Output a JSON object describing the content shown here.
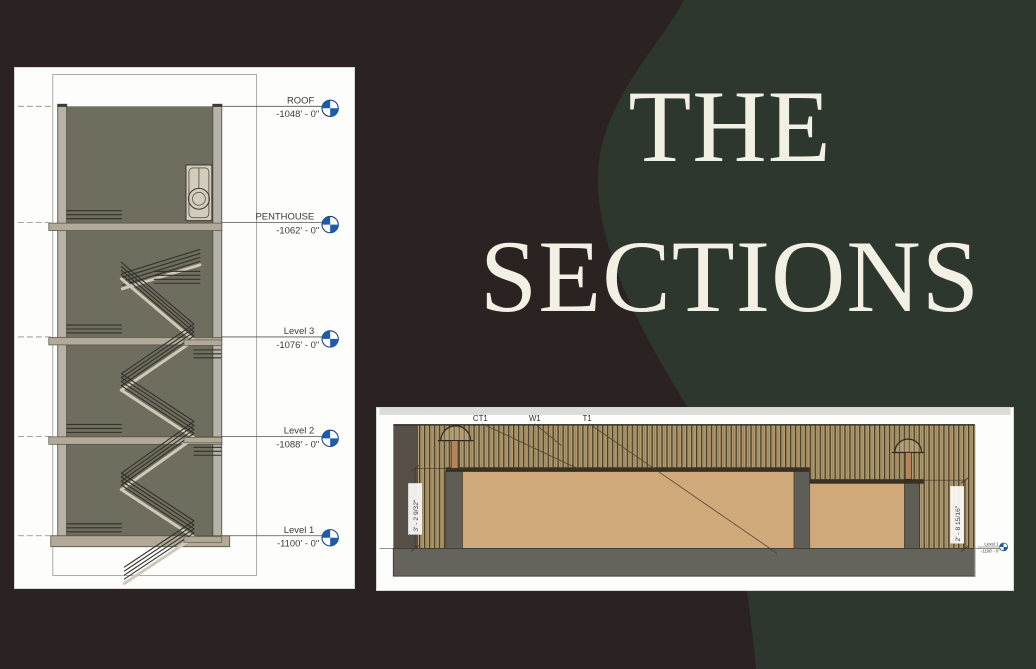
{
  "title": {
    "line1": "THE",
    "line2": "SECTIONS"
  },
  "colors": {
    "background_left": "#2a2321",
    "background_right": "#2d372d",
    "title_text": "#f2f0e5",
    "level_head_blue": "#1d5caa",
    "drawing_interior": "#6f6e5e",
    "counter_wood": "#d0a97a",
    "slat_wall": "#b29b6e"
  },
  "stair_section": {
    "levels": [
      {
        "name": "ROOF",
        "elevation": "-1048' - 0\""
      },
      {
        "name": "PENTHOUSE",
        "elevation": "-1062' - 0\""
      },
      {
        "name": "Level 3",
        "elevation": "-1076' - 0\""
      },
      {
        "name": "Level 2",
        "elevation": "-1088' - 0\""
      },
      {
        "name": "Level 1",
        "elevation": "-1100' - 0\""
      }
    ],
    "icons": [
      "level-head-icon"
    ]
  },
  "counter_section": {
    "tags": [
      "CT1",
      "W1",
      "T1"
    ],
    "dims": {
      "left": "3' - 2 9/32\"",
      "right": "2' - 8 15/16\""
    },
    "marker": {
      "name": "Level 1",
      "elevation": "-1100' - 0\""
    }
  }
}
